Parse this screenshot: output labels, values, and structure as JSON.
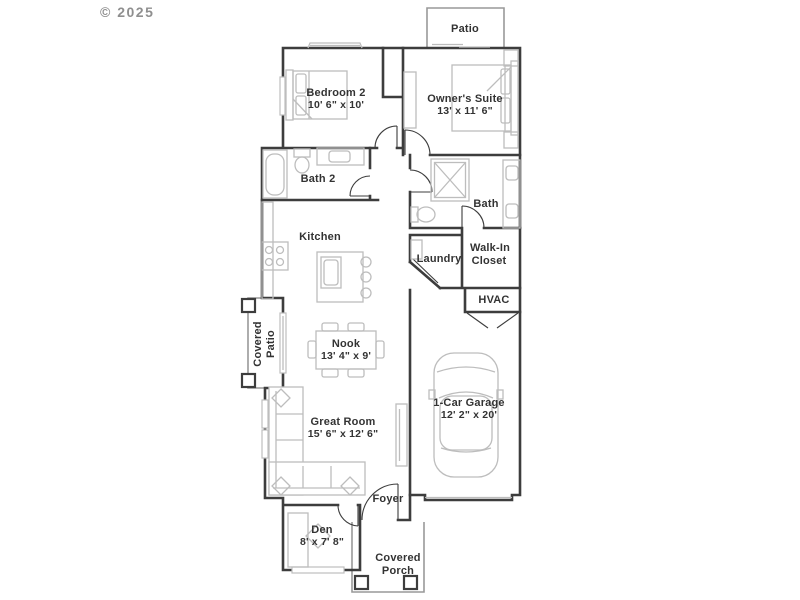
{
  "copyright": "© 2025",
  "rooms": {
    "patio": {
      "name": "Patio"
    },
    "bedroom2": {
      "name": "Bedroom 2",
      "dims": "10' 6\" x 10'"
    },
    "owners_suite": {
      "name": "Owner's Suite",
      "dims": "13' x 11' 6\""
    },
    "bath2": {
      "name": "Bath 2"
    },
    "bath": {
      "name": "Bath"
    },
    "kitchen": {
      "name": "Kitchen"
    },
    "laundry": {
      "name": "Laundry"
    },
    "walk_in_closet": {
      "line1": "Walk-In",
      "line2": "Closet"
    },
    "hvac": {
      "name": "HVAC"
    },
    "covered_patio": {
      "line1": "Covered",
      "line2": "Patio"
    },
    "nook": {
      "name": "Nook",
      "dims": "13' 4\" x 9'"
    },
    "great_room": {
      "name": "Great Room",
      "dims": "15' 6\" x 12' 6\""
    },
    "garage": {
      "name": "1-Car Garage",
      "dims": "12' 2\" x 20'"
    },
    "foyer": {
      "name": "Foyer"
    },
    "den": {
      "name": "Den",
      "dims": "8' x 7' 8\""
    },
    "covered_porch": {
      "line1": "Covered",
      "line2": "Porch"
    }
  },
  "colors": {
    "wall": "#3d3d3d",
    "fixture": "#bdbdbd",
    "outdoor": "#999999",
    "text": "#333333",
    "copyright": "#8f8f8f",
    "background": "#ffffff"
  }
}
